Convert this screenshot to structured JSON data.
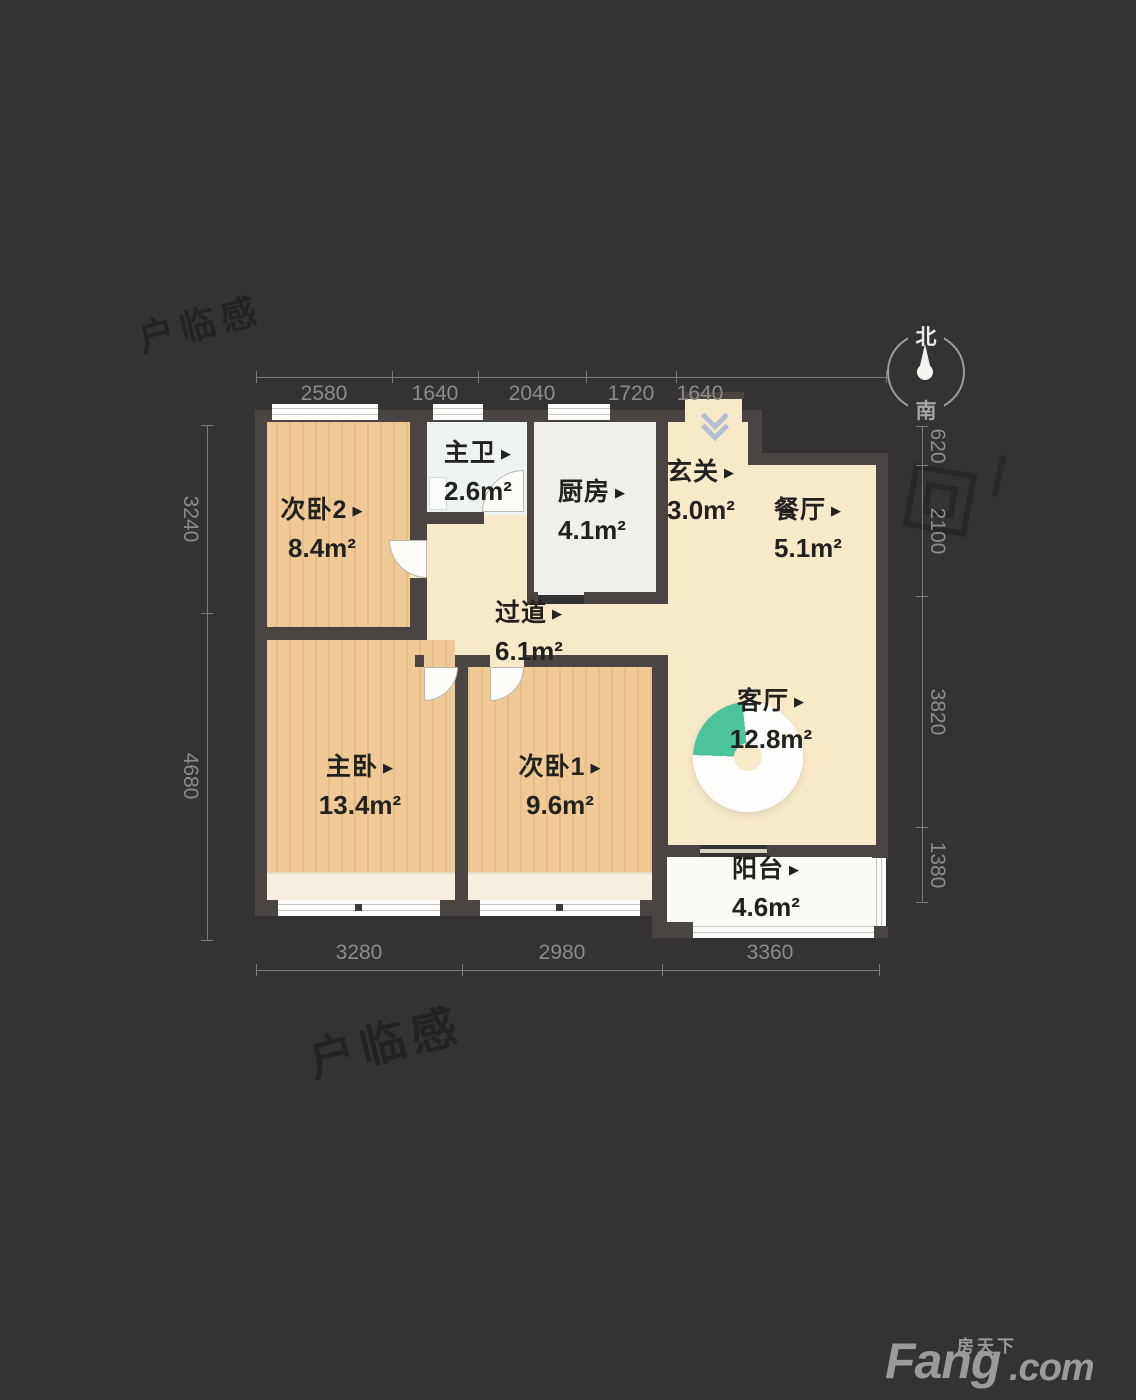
{
  "ui": {
    "arrow": "▶"
  },
  "rooms": [
    {
      "id": "bedroom2",
      "name": "次卧2",
      "area": "8.4m²"
    },
    {
      "id": "master-bath",
      "name": "主卫",
      "area": "2.6m²"
    },
    {
      "id": "kitchen",
      "name": "厨房",
      "area": "4.1m²"
    },
    {
      "id": "entry",
      "name": "玄关",
      "area": "3.0m²"
    },
    {
      "id": "dining",
      "name": "餐厅",
      "area": "5.1m²"
    },
    {
      "id": "hallway",
      "name": "过道",
      "area": "6.1m²"
    },
    {
      "id": "living",
      "name": "客厅",
      "area": "12.8m²"
    },
    {
      "id": "master",
      "name": "主卧",
      "area": "13.4m²"
    },
    {
      "id": "bedroom1",
      "name": "次卧1",
      "area": "9.6m²"
    },
    {
      "id": "balcony",
      "name": "阳台",
      "area": "4.6m²"
    }
  ],
  "dimensions": {
    "top": [
      "2580",
      "1640",
      "2040",
      "1720",
      "1640"
    ],
    "bottom": [
      "3280",
      "2980",
      "3360"
    ],
    "left": [
      "3240",
      "4680"
    ],
    "right": [
      "620",
      "2100",
      "3820",
      "1380"
    ]
  },
  "compass": {
    "north": "北",
    "south": "南"
  },
  "colors": {
    "background": "#343232",
    "wall": "#4a4542",
    "wood_floor": "#f0ca96",
    "cream_floor": "#f8e9c9",
    "sunlight_green": "#4cc39b"
  },
  "watermark": {
    "text": "户临感"
  },
  "logo": {
    "cn": "房天下",
    "en_main": "Fang",
    "en_suffix": ".com"
  }
}
